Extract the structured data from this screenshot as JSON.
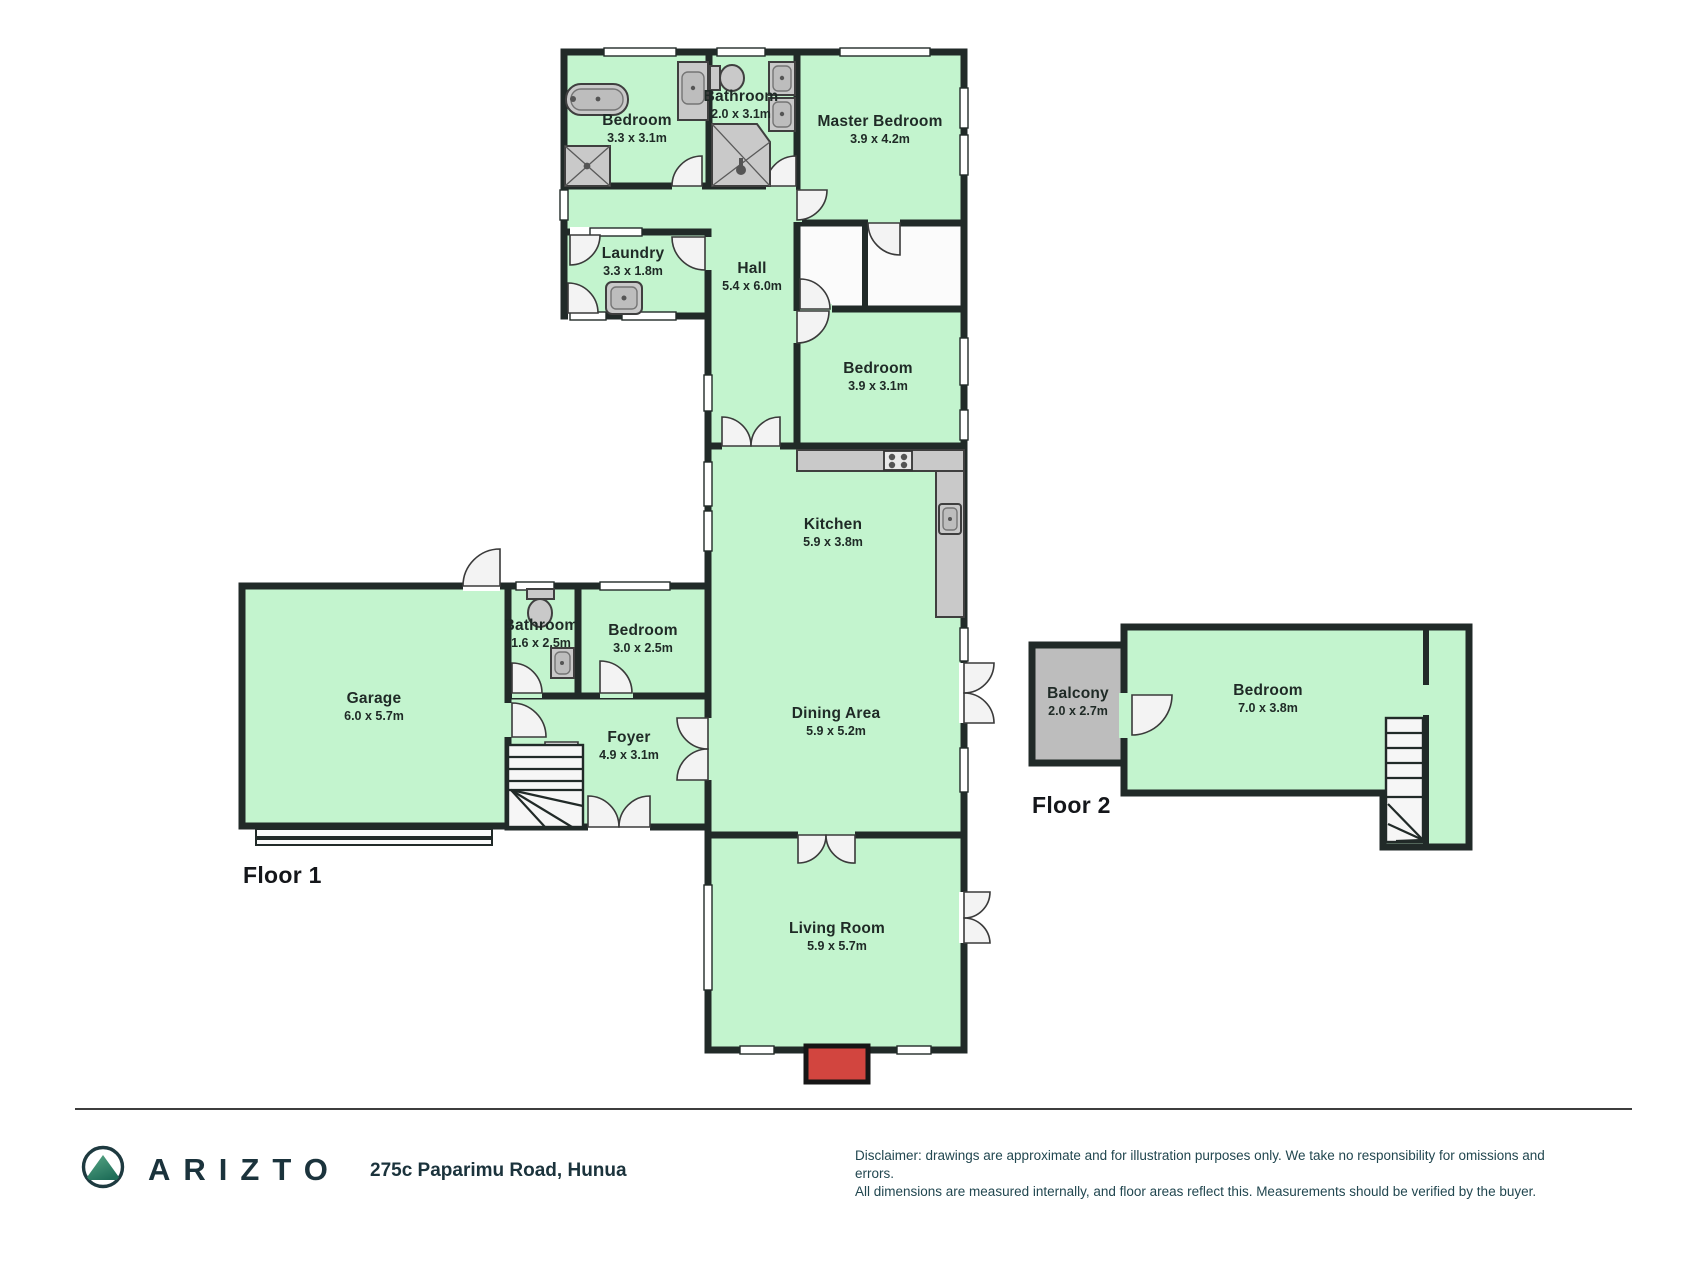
{
  "plan": {
    "floor1_label": "Floor 1",
    "floor2_label": "Floor 2",
    "rooms": {
      "bedroom_top": {
        "name": "Bedroom",
        "dims": "3.3 x 3.1m"
      },
      "bathroom_top": {
        "name": "Bathroom",
        "dims": "2.0 x 3.1m"
      },
      "master_bedroom": {
        "name": "Master Bedroom",
        "dims": "3.9 x 4.2m"
      },
      "laundry": {
        "name": "Laundry",
        "dims": "3.3 x 1.8m"
      },
      "hall": {
        "name": "Hall",
        "dims": "5.4 x 6.0m"
      },
      "bedroom_mid": {
        "name": "Bedroom",
        "dims": "3.9 x 3.1m"
      },
      "kitchen": {
        "name": "Kitchen",
        "dims": "5.9 x 3.8m"
      },
      "garage": {
        "name": "Garage",
        "dims": "6.0 x 5.7m"
      },
      "bathroom_small": {
        "name": "Bathroom",
        "dims": "1.6 x 2.5m"
      },
      "bedroom_small": {
        "name": "Bedroom",
        "dims": "3.0 x 2.5m"
      },
      "foyer": {
        "name": "Foyer",
        "dims": "4.9 x 3.1m"
      },
      "dining": {
        "name": "Dining Area",
        "dims": "5.9 x 5.2m"
      },
      "living": {
        "name": "Living Room",
        "dims": "5.9 x 5.7m"
      },
      "balcony": {
        "name": "Balcony",
        "dims": "2.0 x 2.7m"
      },
      "bedroom_f2": {
        "name": "Bedroom",
        "dims": "7.0 x 3.8m"
      }
    },
    "colors": {
      "room_fill": "#c3f4ce",
      "wall": "#212a28",
      "balcony_fill": "#bdbdbd",
      "fireplace_red": "#d2453f"
    }
  },
  "footer": {
    "brand": "ARIZTO",
    "address": "275c Paparimu Road, Hunua",
    "disclaimer_line1": "Disclaimer: drawings are approximate and for illustration purposes only. We take no responsibility for omissions and errors.",
    "disclaimer_line2": "All dimensions are measured internally, and floor areas reflect this. Measurements should be verified by the buyer."
  },
  "icons": {
    "logo": "arizto-mountain-logo"
  }
}
